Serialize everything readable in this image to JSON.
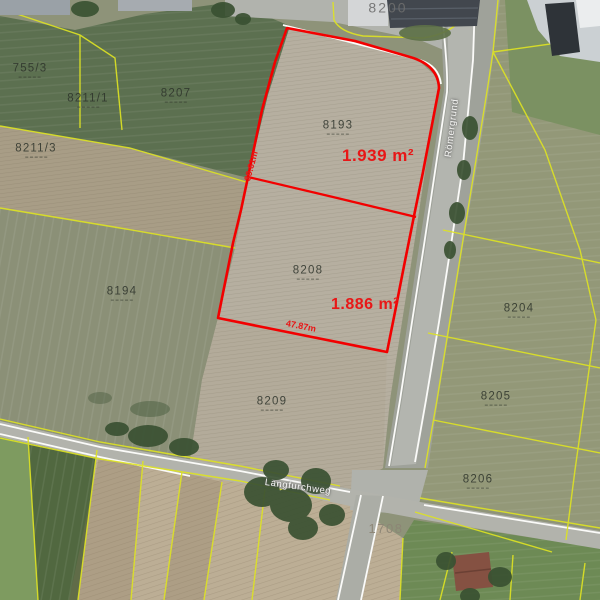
{
  "map": {
    "streets": [
      {
        "name": "Römergrund"
      },
      {
        "name": "Langfurchweg"
      }
    ],
    "parcels": [
      {
        "number": "8200"
      },
      {
        "number": "755/3"
      },
      {
        "number": "8207"
      },
      {
        "number": "8211/1"
      },
      {
        "number": "8211/3"
      },
      {
        "number": "8194"
      },
      {
        "number": "8193"
      },
      {
        "number": "8208"
      },
      {
        "number": "8209"
      },
      {
        "number": "8204"
      },
      {
        "number": "8205"
      },
      {
        "number": "8206"
      },
      {
        "number": "1708"
      }
    ],
    "highlight": {
      "parcels": [
        {
          "number": "8193",
          "area": "1.939 m²"
        },
        {
          "number": "8208",
          "area": "1.886 m²"
        }
      ],
      "dimensions": [
        {
          "label": "39.61m"
        },
        {
          "label": "47.87m"
        }
      ]
    },
    "colors": {
      "highlight_outline": "#f20000",
      "cadastral_boundary": "#dde224",
      "area_text": "#e81717"
    }
  }
}
